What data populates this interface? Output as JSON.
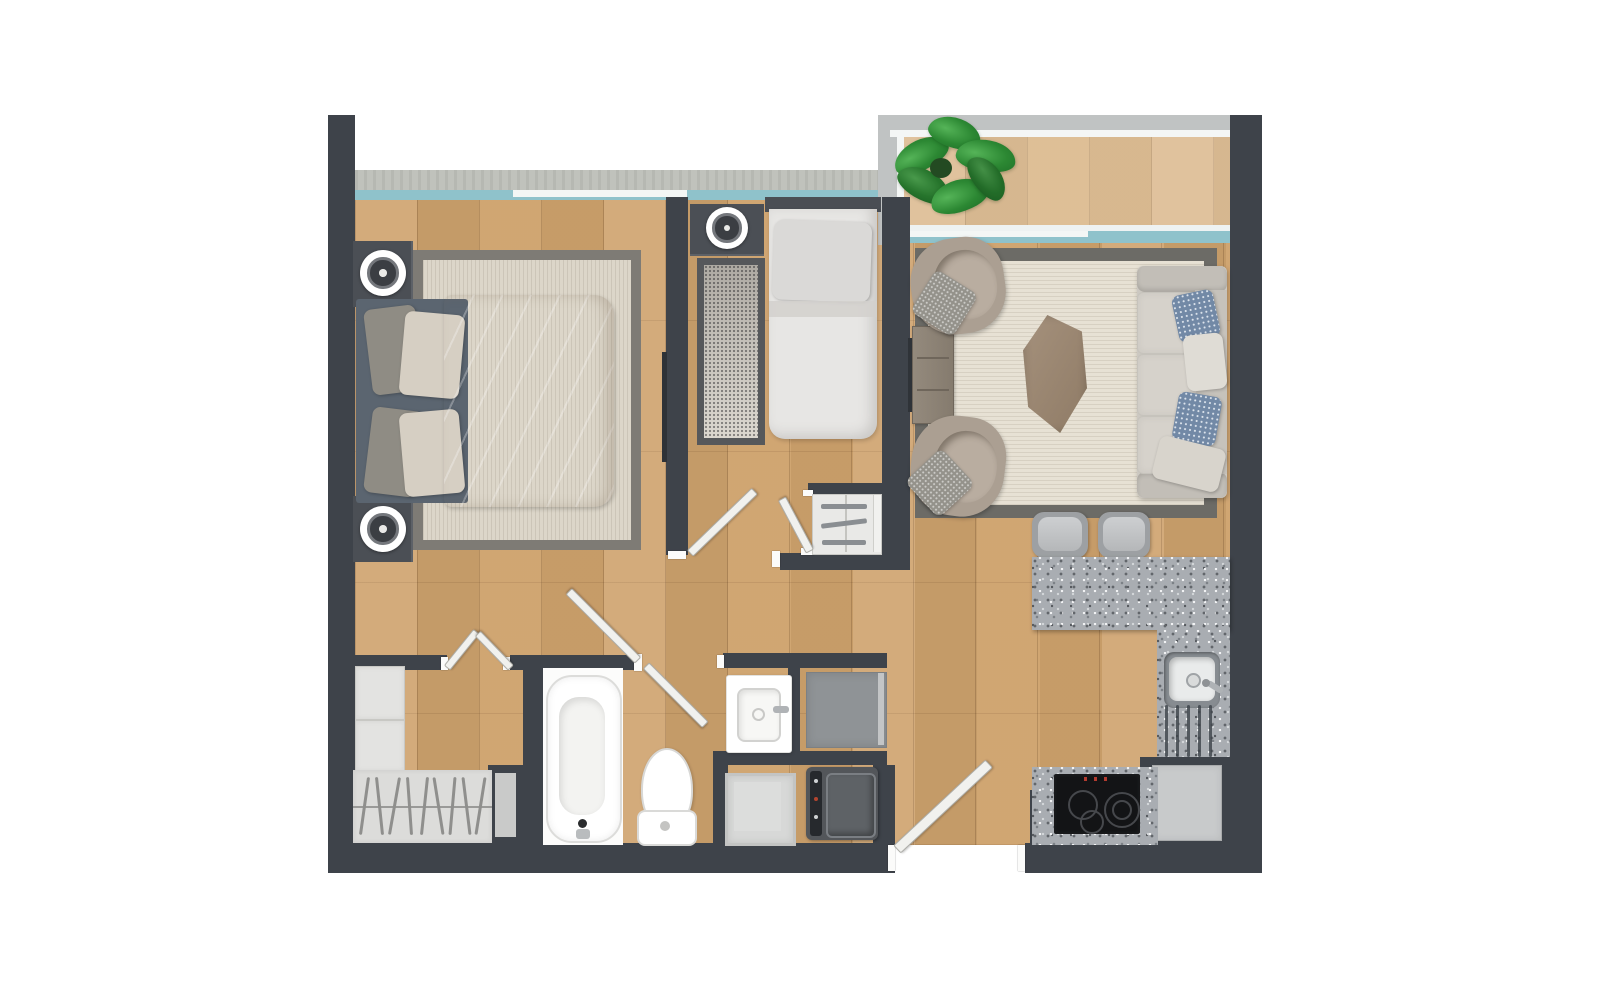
{
  "scene": {
    "kind": "apartment-floor-plan-top-view",
    "rooms": [
      "master-bedroom",
      "second-bedroom",
      "living-room",
      "kitchen",
      "hallway",
      "bathroom",
      "laundry-niche",
      "walk-in-closet",
      "balcony"
    ],
    "furniture": [
      "double-bed",
      "single-bed",
      "nightstand",
      "ceiling-lamp",
      "area-rug",
      "armchair",
      "sofa",
      "coffee-table",
      "console-table",
      "potted-plant",
      "bar-stool",
      "kitchen-counter",
      "kitchen-sink",
      "cooktop",
      "dishwasher",
      "bathtub",
      "toilet",
      "washbasin",
      "shower-tray",
      "washing-machine",
      "storage-cabinet",
      "dresser",
      "wardrobe-shelves",
      "hanging-rail",
      "door-leaf",
      "window",
      "balcony-railing"
    ]
  },
  "palette": {
    "wall": "#3e434a",
    "floor": "#cfa36e",
    "window-teal": "#8fc2cb",
    "window-frame": "#f3f6f5",
    "sill": "#c0c2bc",
    "railing": "#c0c3c3",
    "granite": "#a9adb2",
    "rug-living": "#e7e1d4",
    "rug-living-border": "#6c6b66",
    "rug-bed1": "#dcd6c9",
    "rug-bed1-border": "#7e7b75",
    "rug-bed2-border": "#56585b",
    "sofa": "#ccc8c1",
    "cushion": "#d6d2cb",
    "pillow-blue": "#7289a6",
    "chair": "#ab9f92",
    "wood-furniture": "#9b8a77",
    "bedframe": "#5b6570",
    "duvet": "#d9cfc4",
    "bedding-white": "#e7e6e4",
    "fixture-white": "#ffffff",
    "appliance-dark": "#53565a",
    "appliance-gray": "#8f9396",
    "door-leaf": "#f1f1ee",
    "plant-green": "#2c8833",
    "shelf-gray": "#e3e3e1"
  }
}
